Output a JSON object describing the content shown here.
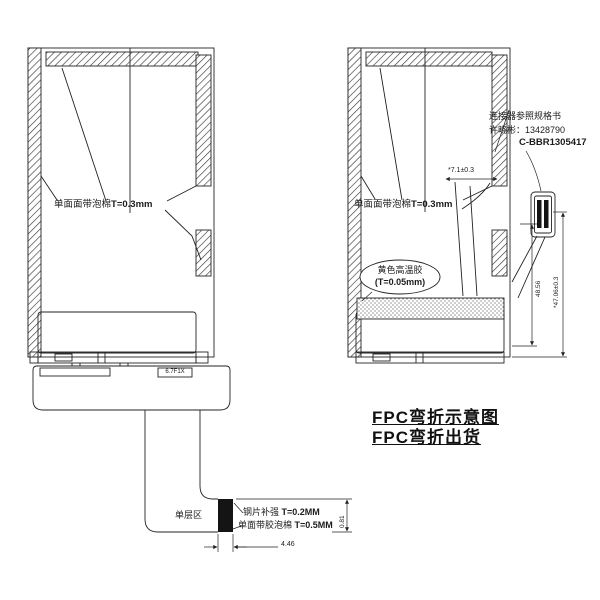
{
  "meta": {
    "type": "fpc-engineering-drawing",
    "colors": {
      "line": "#232323",
      "background": "#ffffff",
      "stiffener_fill": "#141414"
    }
  },
  "left_view": {
    "film_note_label": "单面面带泡棉",
    "film_note_value": "T=0.3mm",
    "single_layer_label": "单层区",
    "stiffener_label": "钢片补强 ",
    "stiffener_value": "T=0.2MM",
    "foam_label": "单面带胶泡棉 ",
    "foam_value": "T=0.5MM",
    "width_dim": "4.46",
    "thickness_dim": "0.81",
    "fpc_marking": "6.7F1X"
  },
  "right_view": {
    "film_note_label": "单面面带泡棉",
    "film_note_value": "T=0.3mm",
    "tape_note_line1": "黄色高温胶",
    "tape_note_line2": "(T=0.05mm)",
    "connector_note": "连接器参照规格书",
    "connector_contact": "许晓彬：13428790",
    "connector_part_no": "C-BBR1305417",
    "top_dim": "*7.1±0.3",
    "height_dim_inner": "48.56",
    "height_dim_outer": "*47.06±0.3"
  },
  "captions": {
    "line1": "FPC弯折示意图",
    "line2": "FPC弯折出货"
  }
}
